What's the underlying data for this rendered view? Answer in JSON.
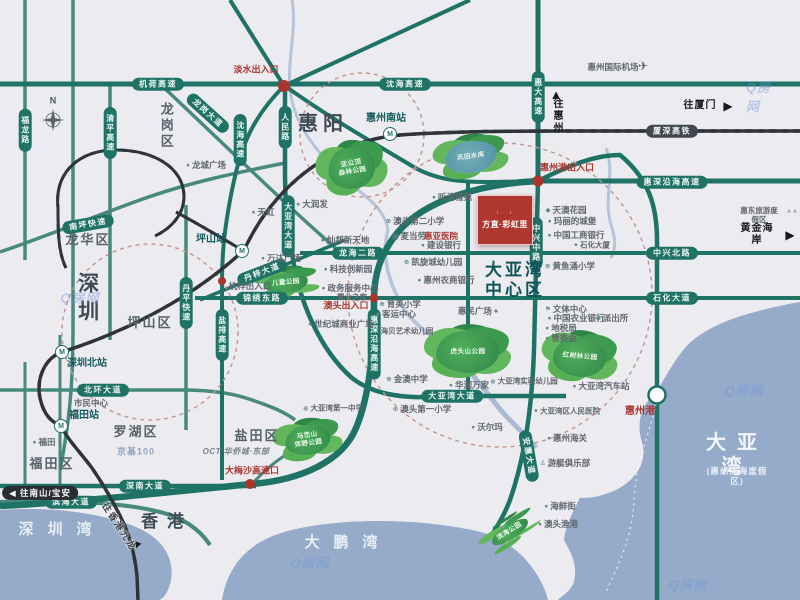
{
  "project": {
    "name": "方直·彩虹里",
    "ornament": "∙ ı ∙ ı ∙"
  },
  "watermark": {
    "text": "Q房网",
    "positions": [
      {
        "x": 80,
        "y": 297
      },
      {
        "x": 310,
        "y": 562
      },
      {
        "x": 744,
        "y": 390
      },
      {
        "x": 688,
        "y": 584
      },
      {
        "x": 764,
        "y": 96
      }
    ]
  },
  "labels": [
    {
      "t": "N",
      "x": 53,
      "y": 101,
      "ty": "cn",
      "nm": "compass-north-label"
    },
    {
      "t": "机荷高速",
      "x": 158,
      "y": 84,
      "ty": "ph",
      "nm": "road-jihe-expwy"
    },
    {
      "t": "沈海高速",
      "x": 405,
      "y": 84,
      "ty": "ph",
      "nm": "road-shenhai-expwy"
    },
    {
      "t": "福龙路",
      "x": 25,
      "y": 130,
      "ty": "pv",
      "nm": "road-fulong"
    },
    {
      "t": "清平高速",
      "x": 110,
      "y": 133,
      "ty": "pv",
      "nm": "road-qingping-expwy"
    },
    {
      "t": "龙岗大道",
      "x": 208,
      "y": 113,
      "ty": "pr",
      "rot": 42,
      "nm": "road-longgang-ave"
    },
    {
      "t": "沈海高速",
      "x": 240,
      "y": 140,
      "ty": "pv",
      "nm": "road-shenhai-expwy-s"
    },
    {
      "t": "人民路",
      "x": 285,
      "y": 127,
      "ty": "pv",
      "nm": "road-renmin"
    },
    {
      "t": "惠大高速",
      "x": 538,
      "y": 97,
      "ty": "pv",
      "nm": "road-huida-expwy"
    },
    {
      "t": "厦深高铁",
      "x": 672,
      "y": 131,
      "ty": "rail",
      "nm": "rail-xiashen-hsr"
    },
    {
      "t": "惠深沿海高速",
      "x": 672,
      "y": 182,
      "ty": "ph",
      "nm": "road-huishen-coastal-expwy"
    },
    {
      "t": "惠深沿海高速",
      "x": 374,
      "y": 344,
      "ty": "pv",
      "nm": "road-huishen-coastal-expwy-v"
    },
    {
      "t": "南坪快速",
      "x": 88,
      "y": 224,
      "ty": "pr",
      "rot": -10,
      "nm": "road-nanping-expwy"
    },
    {
      "t": "丹平快速",
      "x": 186,
      "y": 303,
      "ty": "pv",
      "nm": "road-danping-expwy"
    },
    {
      "t": "盐排高速",
      "x": 222,
      "y": 335,
      "ty": "pv",
      "nm": "road-yanpai-expwy"
    },
    {
      "t": "大亚湾大道",
      "x": 288,
      "y": 226,
      "ty": "pv",
      "nm": "road-dayawan-ave-v"
    },
    {
      "t": "丹梓大道",
      "x": 262,
      "y": 272,
      "ty": "pr",
      "rot": -21,
      "nm": "road-danzi-ave"
    },
    {
      "t": "锦绣东路",
      "x": 262,
      "y": 298,
      "ty": "ph",
      "nm": "road-jinxiu-east"
    },
    {
      "t": "龙海二路",
      "x": 358,
      "y": 253,
      "ty": "ph",
      "nm": "road-longhai-2nd"
    },
    {
      "t": "中兴北路",
      "x": 672,
      "y": 253,
      "ty": "ph",
      "nm": "road-zhongxing-north"
    },
    {
      "t": "石化大道",
      "x": 672,
      "y": 298,
      "ty": "ph",
      "nm": "road-shihua-ave"
    },
    {
      "t": "中兴中路",
      "x": 536,
      "y": 243,
      "ty": "pv",
      "nm": "road-zhongxing-middle"
    },
    {
      "t": "大亚湾大道",
      "x": 452,
      "y": 396,
      "ty": "ph",
      "nm": "road-dayawan-ave-h"
    },
    {
      "t": "安惠大道",
      "x": 529,
      "y": 456,
      "ty": "pr",
      "rot": 80,
      "nm": "road-anhui-ave"
    },
    {
      "t": "深南大道",
      "x": 145,
      "y": 486,
      "ty": "ph",
      "nm": "road-shennan-ave"
    },
    {
      "t": "滨海大道",
      "x": 71,
      "y": 502,
      "ty": "ph",
      "nm": "road-binhai-ave"
    },
    {
      "t": "北环大道",
      "x": 103,
      "y": 390,
      "ty": "ph",
      "nm": "road-beihuan-ave"
    },
    {
      "t": "惠阳",
      "x": 323,
      "y": 124,
      "ty": "city",
      "nm": "region-huiyang"
    },
    {
      "t": "深圳",
      "x": 87,
      "y": 300,
      "ty": "city-v",
      "nm": "region-shenzhen"
    },
    {
      "t": "香港",
      "x": 167,
      "y": 522,
      "ty": "city2",
      "nm": "region-hongkong"
    },
    {
      "t": "龙岗区",
      "x": 166,
      "y": 126,
      "ty": "dist-v",
      "nm": "district-longgang"
    },
    {
      "t": "龙华区",
      "x": 88,
      "y": 240,
      "ty": "dist",
      "nm": "district-longhua"
    },
    {
      "t": "坪山区",
      "x": 150,
      "y": 323,
      "ty": "dist",
      "nm": "district-pingshan"
    },
    {
      "t": "罗湖区",
      "x": 136,
      "y": 432,
      "ty": "dist",
      "nm": "district-luohu"
    },
    {
      "t": "福田区",
      "x": 52,
      "y": 464,
      "ty": "dist",
      "nm": "district-futian"
    },
    {
      "t": "盐田区",
      "x": 257,
      "y": 436,
      "ty": "dist",
      "nm": "district-yantian"
    },
    {
      "t": "大亚湾\n中心区",
      "x": 515,
      "y": 281,
      "ty": "center",
      "nm": "label-dayawan-central"
    },
    {
      "t": "深圳湾",
      "x": 62,
      "y": 530,
      "ty": "water",
      "nm": "water-shenzhen-bay"
    },
    {
      "t": "大鹏湾",
      "x": 348,
      "y": 543,
      "ty": "water",
      "nm": "water-dapeng-bay"
    },
    {
      "t": "大亚湾",
      "x": 737,
      "y": 455,
      "ty": "water-lg",
      "nm": "water-daya-bay"
    },
    {
      "t": "(惠州滨海度假区)",
      "x": 737,
      "y": 476,
      "ty": "water-sub",
      "nm": "water-daya-bay-sub"
    },
    {
      "t": "惠州南站",
      "x": 386,
      "y": 119,
      "ty": "sta",
      "nm": "station-huizhou-south"
    },
    {
      "t": "M",
      "x": 390,
      "y": 134,
      "ty": "micon",
      "nm": "metro-icon"
    },
    {
      "t": "坪山站",
      "x": 211,
      "y": 240,
      "ty": "sta",
      "nm": "station-pingshan"
    },
    {
      "t": "M",
      "x": 242,
      "y": 251,
      "ty": "micon",
      "nm": "metro-icon"
    },
    {
      "t": "深圳北站",
      "x": 87,
      "y": 364,
      "ty": "sta",
      "nm": "station-shenzhen-north"
    },
    {
      "t": "M",
      "x": 62,
      "y": 352,
      "ty": "micon",
      "nm": "metro-icon"
    },
    {
      "t": "福田站",
      "x": 84,
      "y": 416,
      "ty": "sta",
      "nm": "station-futian"
    },
    {
      "t": "M",
      "x": 61,
      "y": 426,
      "ty": "micon",
      "nm": "metro-icon"
    },
    {
      "t": "淡水出入口",
      "x": 256,
      "y": 70,
      "ty": "poi-red",
      "nm": "exit-danshui"
    },
    {
      "t": "惠州港出入口",
      "x": 567,
      "y": 168,
      "ty": "poi-red",
      "nm": "exit-huizhou-port"
    },
    {
      "t": "澳头出入口",
      "x": 346,
      "y": 306,
      "ty": "poi-red",
      "nm": "exit-aotou"
    },
    {
      "t": "大梅沙高速口",
      "x": 252,
      "y": 471,
      "ty": "poi-red",
      "nm": "exit-dameisha"
    },
    {
      "t": "惠亚医院",
      "x": 441,
      "y": 236,
      "ty": "poi-red",
      "fs": 8.5,
      "nm": "poi-huiya-hospital"
    },
    {
      "t": "惠州港",
      "x": 640,
      "y": 412,
      "ty": "poi-red",
      "fs": 10,
      "nm": "poi-huizhou-port"
    },
    {
      "t": "◀ 往南山/宝安",
      "x": 40,
      "y": 493,
      "ty": "dirpill",
      "nm": "direction-nanshan-baoan"
    },
    {
      "t": "▲",
      "x": 556,
      "y": 95,
      "ty": "glyph",
      "fs": 13,
      "nm": "arrow-up-icon"
    },
    {
      "t": "往惠州",
      "x": 556,
      "y": 116,
      "ty": "dir-v",
      "nm": "direction-huizhou"
    },
    {
      "t": "往厦门",
      "x": 700,
      "y": 106,
      "ty": "dir",
      "nm": "direction-xiamen"
    },
    {
      "t": "▶",
      "x": 728,
      "y": 106,
      "ty": "glyph",
      "fs": 12,
      "nm": "arrow-right-icon"
    },
    {
      "t": "黄金海岸",
      "x": 757,
      "y": 235,
      "ty": "dir",
      "nm": "direction-golden-coast"
    },
    {
      "t": "▶",
      "x": 790,
      "y": 235,
      "ty": "glyph",
      "fs": 12,
      "nm": "arrow-right-icon"
    },
    {
      "t": "往香港九龙",
      "x": 119,
      "y": 527,
      "ty": "dir-rot",
      "rot": 57,
      "nm": "direction-hongkong-kowloon"
    },
    {
      "t": "▼",
      "x": 137,
      "y": 546,
      "ty": "glyph",
      "fs": 11,
      "rot": 22,
      "nm": "arrow-down-icon"
    },
    {
      "t": "惠州国际机场",
      "x": 613,
      "y": 67,
      "nm": "poi-huizhou-airport"
    },
    {
      "t": "✈",
      "x": 643,
      "y": 66,
      "ty": "glyph",
      "fs": 12,
      "col": "#5a646c",
      "nm": "airplane-icon"
    },
    {
      "t": "惠东旅游度假区",
      "x": 759,
      "y": 215,
      "fs": 7.5,
      "nm": "poi-huidong-resort"
    },
    {
      "t": "▲▲",
      "x": 792,
      "y": 212,
      "ty": "glyph",
      "fs": 6,
      "col": "#98a2ab",
      "nm": "mountain-icon"
    },
    {
      "t": "龙城广场",
      "x": 206,
      "y": 165,
      "ic": "●",
      "nm": "poi-longcheng-square"
    },
    {
      "t": "天虹",
      "x": 263,
      "y": 212,
      "ic": "●",
      "nm": "poi-tianhong"
    },
    {
      "t": "大润发",
      "x": 312,
      "y": 204,
      "ic": "●",
      "nm": "poi-rtmart"
    },
    {
      "t": "万达广场",
      "x": 281,
      "y": 258,
      "ic": "●",
      "nm": "poi-wanda-plaza"
    },
    {
      "t": "坑梓出入口",
      "x": 250,
      "y": 286,
      "nm": "exit-kengzi"
    },
    {
      "t": "灿邦新天地",
      "x": 345,
      "y": 240,
      "ic": "●",
      "nm": "poi-canbang-xintiandi"
    },
    {
      "t": "科技创新园",
      "x": 348,
      "y": 269,
      "ic": "●",
      "nm": "poi-tech-innovation-park"
    },
    {
      "t": "政务服务中心",
      "x": 350,
      "y": 288,
      "ic": "●",
      "nm": "poi-gov-service-center"
    },
    {
      "t": "置业之家",
      "x": 352,
      "y": 297,
      "fs": 7.5,
      "nm": "poi-zhiye-home"
    },
    {
      "t": "世纪城商业广场",
      "x": 341,
      "y": 324,
      "ic": "●",
      "nm": "poi-century-city-plaza"
    },
    {
      "t": "育英小学",
      "x": 400,
      "y": 304,
      "ic": "⊕",
      "nm": "poi-yuying-primary"
    },
    {
      "t": "客运中心",
      "x": 396,
      "y": 314,
      "ic": "●",
      "nm": "poi-passenger-center"
    },
    {
      "t": "海贝艺术幼儿园",
      "x": 407,
      "y": 331,
      "fs": 7.5,
      "nm": "poi-haibei-kindergarten"
    },
    {
      "t": "听涛雅苑",
      "x": 452,
      "y": 197,
      "ic": "●",
      "nm": "poi-tingtao-yayuan"
    },
    {
      "t": "澳头第二小学",
      "x": 415,
      "y": 221,
      "ic": "⊕",
      "nm": "poi-aotou-no2-primary"
    },
    {
      "t": "麦当劳",
      "x": 409,
      "y": 236,
      "ic": "Ⓜ",
      "nm": "poi-mcdonalds"
    },
    {
      "t": "建设银行",
      "x": 441,
      "y": 245,
      "ic": "●",
      "nm": "poi-ccb-bank"
    },
    {
      "t": "天澳花园",
      "x": 566,
      "y": 210,
      "ic": "◆",
      "nm": "poi-tianao-garden"
    },
    {
      "t": "玛丽的城堡",
      "x": 572,
      "y": 221,
      "ic": "●",
      "nm": "poi-marys-castle"
    },
    {
      "t": "中国工商银行",
      "x": 576,
      "y": 235,
      "ic": "●",
      "nm": "poi-icbc-bank"
    },
    {
      "t": "石化大厦",
      "x": 592,
      "y": 245,
      "ic": "●",
      "fs": 7.5,
      "nm": "poi-shihua-tower"
    },
    {
      "t": "凯旋城幼儿园",
      "x": 433,
      "y": 262,
      "ic": "⊕",
      "nm": "poi-kaixuancheng-kindergarten"
    },
    {
      "t": "惠州农商银行",
      "x": 446,
      "y": 280,
      "ic": "●",
      "nm": "poi-huizhou-rural-bank"
    },
    {
      "t": "黄鱼涌小学",
      "x": 570,
      "y": 266,
      "ic": "⊕",
      "nm": "poi-huangyuchong-primary"
    },
    {
      "t": "惠民广场",
      "x": 478,
      "y": 311,
      "ir": "♣",
      "nm": "poi-huimin-square"
    },
    {
      "t": "文体中心",
      "x": 566,
      "y": 309,
      "ic": "⚑",
      "nm": "poi-culture-sports-center"
    },
    {
      "t": "中国农业银行",
      "x": 576,
      "y": 318,
      "ic": "●",
      "nm": "poi-abc-bank"
    },
    {
      "t": "派出所",
      "x": 612,
      "y": 318,
      "ic": "◆",
      "nm": "poi-police-station"
    },
    {
      "t": "地税局",
      "x": 561,
      "y": 328,
      "ic": "●",
      "nm": "poi-tax-bureau"
    },
    {
      "t": "管委会",
      "x": 561,
      "y": 338,
      "ic": "●",
      "nm": "poi-management-committee"
    },
    {
      "t": "金澳中学",
      "x": 407,
      "y": 379,
      "ic": "⊕",
      "nm": "poi-jinao-middle-school"
    },
    {
      "t": "华润万家",
      "x": 469,
      "y": 385,
      "ic": "●",
      "nm": "poi-crv-vanguard"
    },
    {
      "t": "大亚湾实验幼儿园",
      "x": 524,
      "y": 381,
      "ic": "⊕",
      "fs": 7.5,
      "nm": "poi-dayawan-exp-kindergarten"
    },
    {
      "t": "大亚湾汽车站",
      "x": 601,
      "y": 386,
      "ic": "●",
      "nm": "poi-dayawan-bus-station"
    },
    {
      "t": "澳头第一小学",
      "x": 422,
      "y": 409,
      "ic": "⊕",
      "nm": "poi-aotou-no1-primary"
    },
    {
      "t": "大亚湾区人民医院",
      "x": 567,
      "y": 411,
      "ic": "●",
      "fs": 7.5,
      "nm": "poi-dayawan-peoples-hospital"
    },
    {
      "t": "沃尔玛",
      "x": 487,
      "y": 427,
      "ic": "●",
      "nm": "poi-walmart"
    },
    {
      "t": "惠州海关",
      "x": 567,
      "y": 438,
      "ic": "●",
      "nm": "poi-huizhou-customs"
    },
    {
      "t": "游艇俱乐部",
      "x": 565,
      "y": 463,
      "ic": "⚓",
      "nm": "poi-yacht-club"
    },
    {
      "t": "海鲜街",
      "x": 560,
      "y": 506,
      "ic": "●",
      "nm": "poi-seafood-street"
    },
    {
      "t": "澳头渔港",
      "x": 558,
      "y": 524,
      "ic": "●",
      "nm": "poi-aotou-fishing-port"
    },
    {
      "t": "大亚湾第一中学",
      "x": 333,
      "y": 408,
      "ic": "⊕",
      "fs": 7.5,
      "nm": "poi-dayawan-no1-middle"
    },
    {
      "t": "OCT 华侨城·东部",
      "x": 236,
      "y": 452,
      "ty": "oct",
      "nm": "poi-oct-east"
    },
    {
      "t": "市民中心",
      "x": 88,
      "y": 403,
      "ic": "●",
      "nm": "poi-civic-center"
    },
    {
      "t": "京基100",
      "x": 136,
      "y": 452,
      "ty": "kk",
      "nm": "poi-kk100"
    },
    {
      "t": "福田",
      "x": 44,
      "y": 442,
      "ic": "●",
      "nm": "poi-futian"
    }
  ],
  "parks": [
    {
      "t": "亚公顶\n森林公园",
      "x": 352,
      "y": 168,
      "w": 48,
      "h": 42,
      "rot": -10,
      "nm": "park-yagongding-forest"
    },
    {
      "t": "风田水库",
      "x": 471,
      "y": 157,
      "w": 52,
      "h": 32,
      "rot": -8,
      "kind": "water",
      "nm": "park-fengtian-reservoir"
    },
    {
      "t": "儿童公园",
      "x": 286,
      "y": 283,
      "w": 44,
      "h": 20,
      "rot": -5,
      "nm": "park-children"
    },
    {
      "t": "虎头山公园",
      "x": 468,
      "y": 352,
      "w": 64,
      "h": 42,
      "rot": 0,
      "nm": "park-hutoushan"
    },
    {
      "t": "红树林公园",
      "x": 580,
      "y": 357,
      "w": 54,
      "h": 40,
      "rot": 5,
      "nm": "park-hongshulin"
    },
    {
      "t": "马峦山\n郊野公园",
      "x": 308,
      "y": 440,
      "w": 46,
      "h": 30,
      "rot": -8,
      "nm": "park-maluanshan"
    },
    {
      "t": "滨海公园",
      "x": 510,
      "y": 532,
      "w": 42,
      "h": 15,
      "rot": -32,
      "nm": "park-binhai"
    }
  ]
}
